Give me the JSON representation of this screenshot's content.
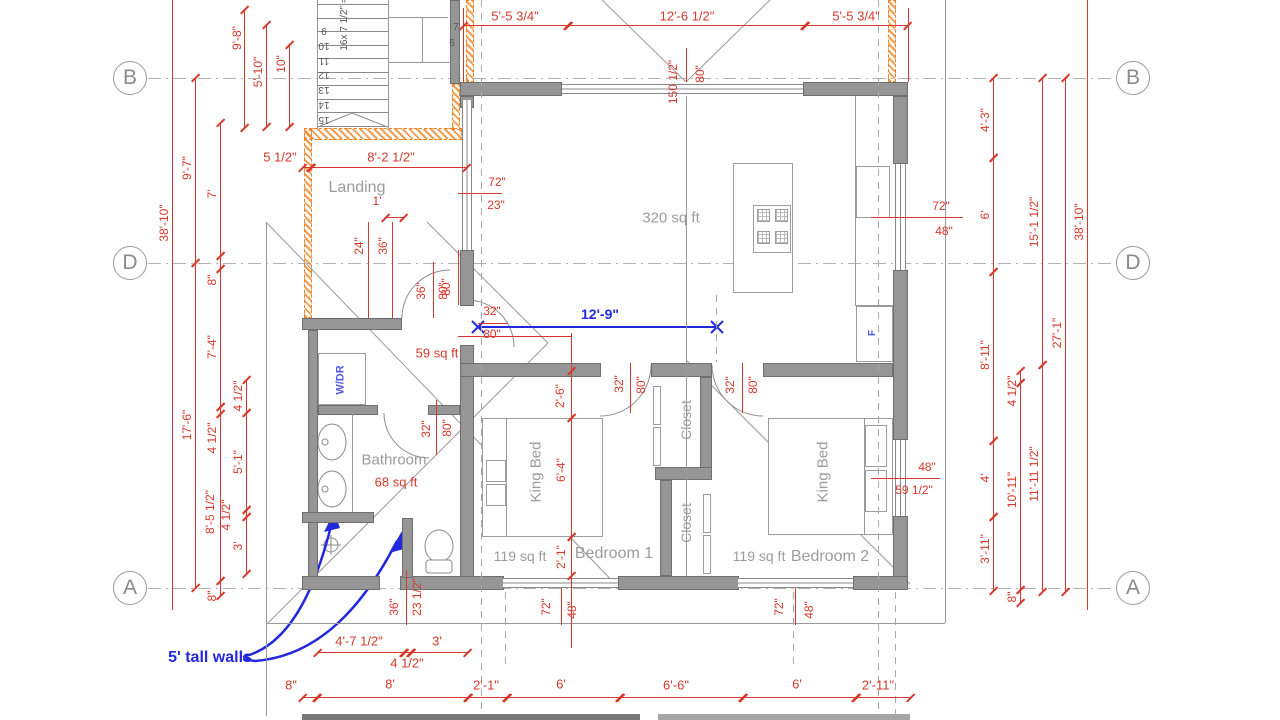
{
  "title": "First floor plan drawing",
  "colors": {
    "dimension_red": "#d6382c",
    "annotation_blue": "#2328dc",
    "wall_gray": "#969696",
    "label_gray": "#9c9c9c",
    "new_wall_orange": "#f08223"
  },
  "grid": {
    "markers": [
      {
        "letter": "B",
        "x": 130,
        "y": 78
      },
      {
        "letter": "D",
        "x": 130,
        "y": 263
      },
      {
        "letter": "A",
        "x": 130,
        "y": 588
      },
      {
        "letter": "B",
        "x": 1133,
        "y": 78
      },
      {
        "letter": "D",
        "x": 1133,
        "y": 263
      },
      {
        "letter": "A",
        "x": 1133,
        "y": 588
      }
    ]
  },
  "rooms": [
    {
      "label": "Landing"
    },
    {
      "area": "320 sq ft"
    },
    {
      "area": "59 sq ft"
    },
    {
      "label": "Bathroom",
      "area": "68 sq ft"
    },
    {
      "label": "Bedroom 1",
      "area": "119 sq ft"
    },
    {
      "label": "Bedroom 2",
      "area": "119 sq ft"
    },
    {
      "label": "Closet"
    },
    {
      "label": "Closet"
    }
  ],
  "stairs": {
    "note": "16x 7 1/2\" =",
    "treads": [
      "9",
      "10",
      "11",
      "12",
      "13",
      "14",
      "15"
    ],
    "winders": [
      "7",
      "6"
    ]
  },
  "blue_dimension": {
    "label": "12'-9\""
  },
  "wall_note": "5' tall walls",
  "labels": [
    {
      "t": "5'-5 3/4\"",
      "x": 515,
      "y": 16,
      "s": 13
    },
    {
      "t": "12'-6 1/2\"",
      "x": 687,
      "y": 16,
      "s": 13
    },
    {
      "t": "5'-5 3/4\"",
      "x": 856,
      "y": 16,
      "s": 13
    },
    {
      "t": "150 1/2\"",
      "x": 673,
      "y": 82,
      "r": 1
    },
    {
      "t": "80\"",
      "x": 700,
      "y": 74,
      "r": 1
    },
    {
      "t": "9'-8\"",
      "x": 237,
      "y": 38,
      "r": 1
    },
    {
      "t": "5'-10\"",
      "x": 258,
      "y": 72,
      "r": 1
    },
    {
      "t": "10\"",
      "x": 281,
      "y": 64,
      "r": 1
    },
    {
      "t": "38'-10\"",
      "x": 164,
      "y": 223,
      "r": 1
    },
    {
      "t": "9'-7\"",
      "x": 187,
      "y": 168,
      "r": 1
    },
    {
      "t": "7'",
      "x": 212,
      "y": 194,
      "r": 1
    },
    {
      "t": "8\"",
      "x": 212,
      "y": 280,
      "r": 1
    },
    {
      "t": "7'-4\"",
      "x": 212,
      "y": 347,
      "r": 1
    },
    {
      "t": "17'-6\"",
      "x": 187,
      "y": 425,
      "r": 1
    },
    {
      "t": "4 1/2\"",
      "x": 212,
      "y": 438,
      "r": 1
    },
    {
      "t": "4 1/2\"",
      "x": 238,
      "y": 396,
      "r": 1
    },
    {
      "t": "5'-1\"",
      "x": 238,
      "y": 462,
      "r": 1
    },
    {
      "t": "8'-5 1/2\"",
      "x": 210,
      "y": 512,
      "r": 1
    },
    {
      "t": "4 1/2\"",
      "x": 226,
      "y": 515,
      "r": 1
    },
    {
      "t": "3'",
      "x": 238,
      "y": 546,
      "r": 1
    },
    {
      "t": "8\"",
      "x": 212,
      "y": 596,
      "r": 1
    },
    {
      "t": "4'-3\"",
      "x": 985,
      "y": 120,
      "r": 1
    },
    {
      "t": "6'",
      "x": 985,
      "y": 215,
      "r": 1
    },
    {
      "t": "8'-11\"",
      "x": 985,
      "y": 355,
      "r": 1
    },
    {
      "t": "4'",
      "x": 985,
      "y": 478,
      "r": 1
    },
    {
      "t": "3'-11\"",
      "x": 985,
      "y": 549,
      "r": 1
    },
    {
      "t": "4 1/2\"",
      "x": 1012,
      "y": 391,
      "r": 1
    },
    {
      "t": "10'-11\"",
      "x": 1012,
      "y": 490,
      "r": 1
    },
    {
      "t": "8\"",
      "x": 1012,
      "y": 597,
      "r": 1
    },
    {
      "t": "15'-1 1/2\"",
      "x": 1034,
      "y": 222,
      "r": 1
    },
    {
      "t": "11'-11 1/2\"",
      "x": 1034,
      "y": 474,
      "r": 1
    },
    {
      "t": "27'-1\"",
      "x": 1057,
      "y": 333,
      "r": 1
    },
    {
      "t": "38'-10\"",
      "x": 1079,
      "y": 222,
      "r": 1
    },
    {
      "t": "5 1/2\"",
      "x": 280,
      "y": 157,
      "s": 13
    },
    {
      "t": "8'-2 1/2\"",
      "x": 391,
      "y": 157,
      "s": 13
    },
    {
      "t": "Landing",
      "x": 357,
      "y": 188,
      "c": "g",
      "s": 16,
      "n": "room-label-landing"
    },
    {
      "t": "1'",
      "x": 377,
      "y": 201
    },
    {
      "t": "24\"",
      "x": 359,
      "y": 246,
      "r": 1
    },
    {
      "t": "36\"",
      "x": 383,
      "y": 246,
      "r": 1
    },
    {
      "t": "36\"",
      "x": 421,
      "y": 291,
      "r": 1
    },
    {
      "t": "80\"",
      "x": 443,
      "y": 291,
      "r": 1
    },
    {
      "t": "16x 7 1/2\" =",
      "x": 345,
      "y": 24,
      "r": 1,
      "c": "k",
      "s": 10,
      "n": "stair-note"
    },
    {
      "t": "7",
      "x": 456,
      "y": 28,
      "c": "k",
      "s": 10,
      "n": "winder-number"
    },
    {
      "t": "6",
      "x": 452,
      "y": 44,
      "c": "k",
      "s": 10,
      "n": "winder-number"
    },
    {
      "t": "72\"",
      "x": 497,
      "y": 182
    },
    {
      "t": "23\"",
      "x": 496,
      "y": 205
    },
    {
      "t": "320 sq ft",
      "x": 671,
      "y": 218,
      "c": "g",
      "s": 15,
      "n": "room-area-label"
    },
    {
      "t": "32\"",
      "x": 492,
      "y": 311
    },
    {
      "t": "80\"",
      "x": 492,
      "y": 334
    },
    {
      "t": "80\"",
      "x": 446,
      "y": 287,
      "r": 1
    },
    {
      "t": "72\"",
      "x": 941,
      "y": 206
    },
    {
      "t": "48\"",
      "x": 944,
      "y": 231
    },
    {
      "t": "F",
      "x": 873,
      "y": 333,
      "r": 1,
      "c": "lb",
      "s": 10,
      "n": "fridge-label"
    },
    {
      "t": "59 sq ft",
      "x": 437,
      "y": 353,
      "s": 13,
      "n": "room-area-label"
    },
    {
      "t": "W/DR",
      "x": 341,
      "y": 380,
      "r": 1,
      "c": "lb",
      "s": 11,
      "n": "washer-dryer-label"
    },
    {
      "t": "Bathroom",
      "x": 394,
      "y": 460,
      "c": "g",
      "s": 15,
      "n": "room-label-bathroom"
    },
    {
      "t": "68 sq ft",
      "x": 396,
      "y": 482,
      "s": 13,
      "n": "room-area-label"
    },
    {
      "t": "32\"",
      "x": 426,
      "y": 429,
      "r": 1
    },
    {
      "t": "80\"",
      "x": 447,
      "y": 428,
      "r": 1
    },
    {
      "t": "2'-6\"",
      "x": 560,
      "y": 396,
      "r": 1
    },
    {
      "t": "6'-4\"",
      "x": 561,
      "y": 470,
      "r": 1
    },
    {
      "t": "2'-1\"",
      "x": 561,
      "y": 557,
      "r": 1
    },
    {
      "t": "32\"",
      "x": 619,
      "y": 384,
      "r": 1
    },
    {
      "t": "80\"",
      "x": 641,
      "y": 385,
      "r": 1
    },
    {
      "t": "King Bed",
      "x": 536,
      "y": 472,
      "r": 1,
      "c": "g",
      "s": 15,
      "n": "furniture-label-king-bed"
    },
    {
      "t": "119 sq ft",
      "x": 520,
      "y": 556,
      "c": "g",
      "s": 14,
      "n": "room-area-label"
    },
    {
      "t": "Bedroom 1",
      "x": 614,
      "y": 554,
      "c": "g",
      "s": 16,
      "n": "room-label-bedroom-1"
    },
    {
      "t": "Closet",
      "x": 686,
      "y": 420,
      "r": 1,
      "c": "g",
      "s": 14,
      "n": "room-label-closet"
    },
    {
      "t": "Closet",
      "x": 686,
      "y": 523,
      "r": 1,
      "c": "g",
      "s": 14,
      "n": "room-label-closet"
    },
    {
      "t": "32\"",
      "x": 730,
      "y": 385,
      "r": 1
    },
    {
      "t": "80\"",
      "x": 753,
      "y": 385,
      "r": 1
    },
    {
      "t": "King Bed",
      "x": 823,
      "y": 472,
      "r": 1,
      "c": "g",
      "s": 15,
      "n": "furniture-label-king-bed"
    },
    {
      "t": "119 sq ft",
      "x": 759,
      "y": 556,
      "c": "g",
      "s": 14,
      "n": "room-area-label"
    },
    {
      "t": "Bedroom 2",
      "x": 830,
      "y": 557,
      "c": "g",
      "s": 16,
      "n": "room-label-bedroom-2"
    },
    {
      "t": "48\"",
      "x": 927,
      "y": 467
    },
    {
      "t": "59 1/2\"",
      "x": 914,
      "y": 490
    },
    {
      "t": "72\"",
      "x": 546,
      "y": 607,
      "r": 1
    },
    {
      "t": "48\"",
      "x": 572,
      "y": 610,
      "r": 1
    },
    {
      "t": "72\"",
      "x": 779,
      "y": 607,
      "r": 1
    },
    {
      "t": "48\"",
      "x": 809,
      "y": 610,
      "r": 1
    },
    {
      "t": "36\"",
      "x": 394,
      "y": 607,
      "r": 1
    },
    {
      "t": "23 1/2\"",
      "x": 417,
      "y": 597,
      "r": 1
    },
    {
      "t": "4'-7 1/2\"",
      "x": 359,
      "y": 641,
      "s": 13
    },
    {
      "t": "3'",
      "x": 437,
      "y": 641,
      "s": 13
    },
    {
      "t": "4 1/2\"",
      "x": 407,
      "y": 663,
      "s": 13
    },
    {
      "t": "8\"",
      "x": 291,
      "y": 685,
      "s": 13
    },
    {
      "t": "8'",
      "x": 390,
      "y": 684,
      "s": 13
    },
    {
      "t": "2'-1\"",
      "x": 486,
      "y": 685,
      "s": 13
    },
    {
      "t": "6'",
      "x": 561,
      "y": 684,
      "s": 13
    },
    {
      "t": "6'-6\"",
      "x": 676,
      "y": 685,
      "s": 13
    },
    {
      "t": "6'",
      "x": 797,
      "y": 684,
      "s": 13
    },
    {
      "t": "2'-11\"",
      "x": 878,
      "y": 685,
      "s": 13
    },
    {
      "t": "12'-9\"",
      "x": 600,
      "y": 314,
      "c": "b",
      "s": 14,
      "n": "blue-dimension-label"
    },
    {
      "t": "5' tall walls",
      "x": 210,
      "y": 658,
      "c": "b",
      "s": 16,
      "n": "wall-height-note"
    }
  ]
}
